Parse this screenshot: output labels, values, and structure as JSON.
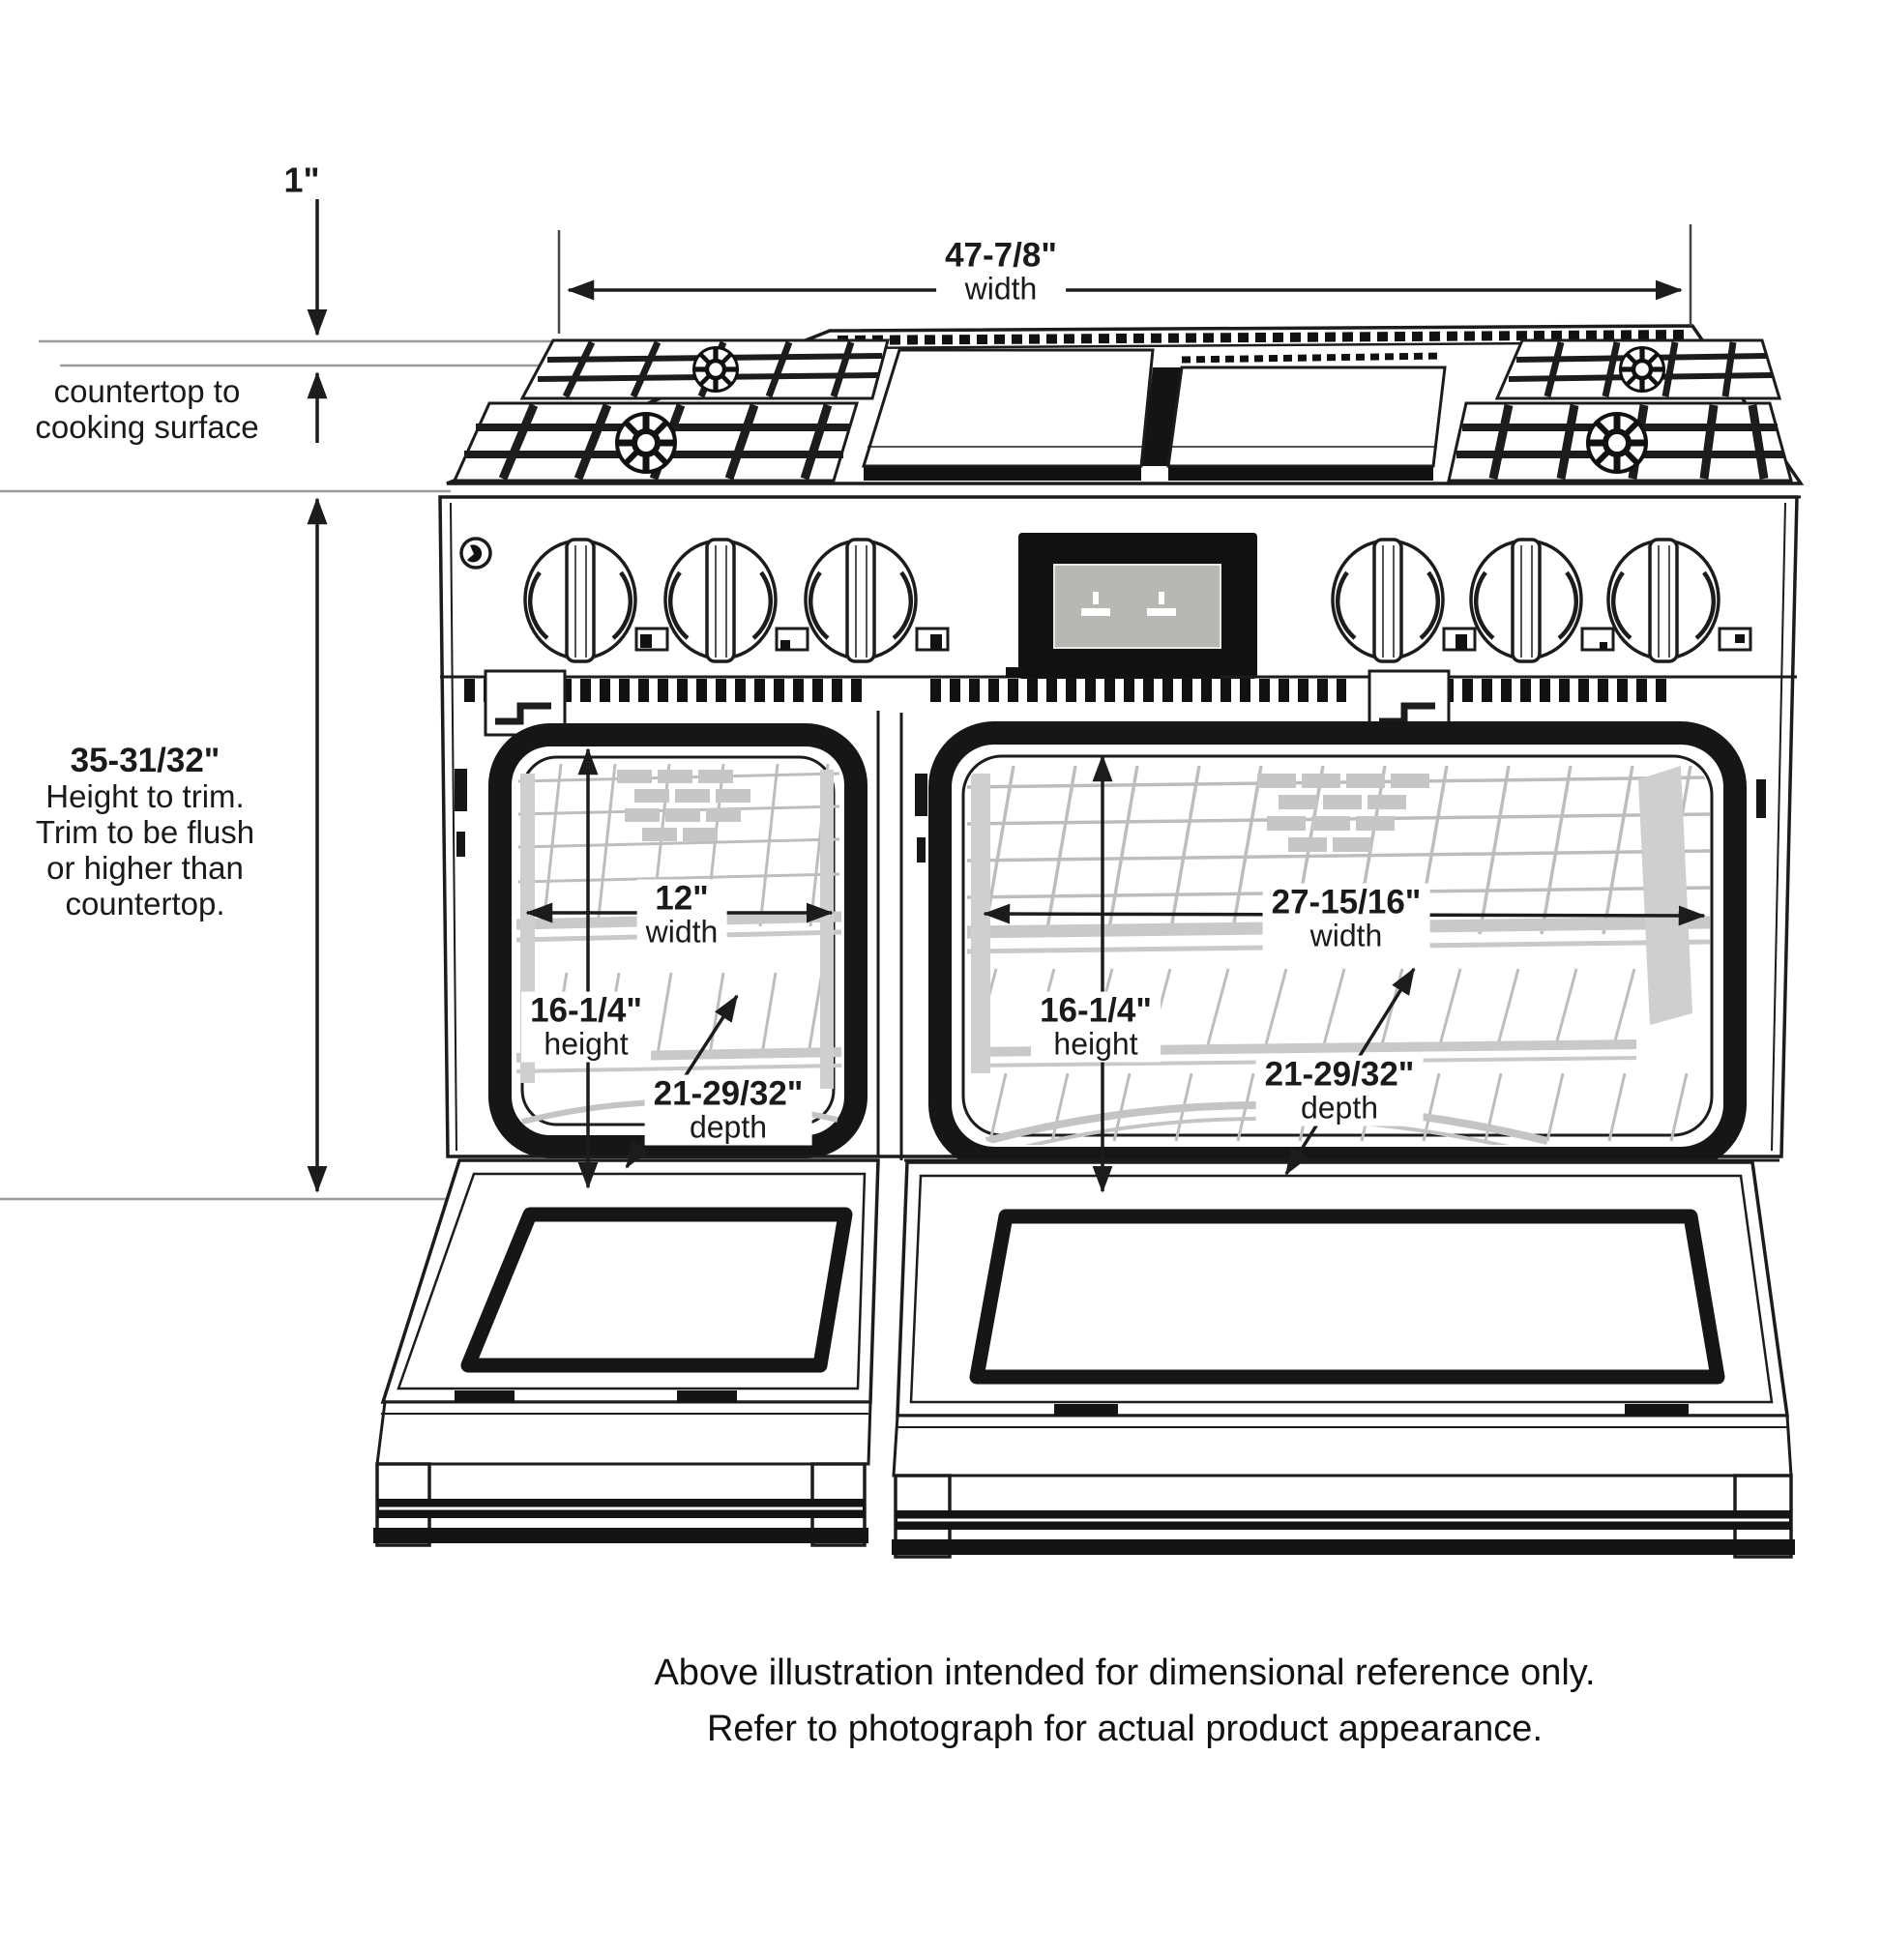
{
  "diagram": {
    "title_hidden": "",
    "top_width": {
      "value": "47-7/8\"",
      "label": "width"
    },
    "gap": {
      "value": "1\""
    },
    "countertop_note": {
      "line1": "countertop to",
      "line2": "cooking surface"
    },
    "height_note": {
      "value": "35-31/32\"",
      "line1": "Height to trim.",
      "line2": "Trim to be flush",
      "line3": "or higher than",
      "line4": "countertop."
    },
    "small_oven": {
      "width": {
        "value": "12\"",
        "label": "width"
      },
      "height": {
        "value": "16-1/4\"",
        "label": "height"
      },
      "depth": {
        "value": "21-29/32\"",
        "label": "depth"
      }
    },
    "large_oven": {
      "width": {
        "value": "27-15/16\"",
        "label": "width"
      },
      "height": {
        "value": "16-1/4\"",
        "label": "height"
      },
      "depth": {
        "value": "21-29/32\"",
        "label": "depth"
      }
    },
    "caption": {
      "line1": "Above illustration intended for dimensional reference only.",
      "line2": "Refer to photograph for actual product appearance."
    },
    "colors": {
      "ink": "#1c1c1c",
      "reference_line": "#9b9b9b",
      "interior_artwork": "#bdbdbd",
      "display_screen": "#b7b7b3"
    }
  }
}
